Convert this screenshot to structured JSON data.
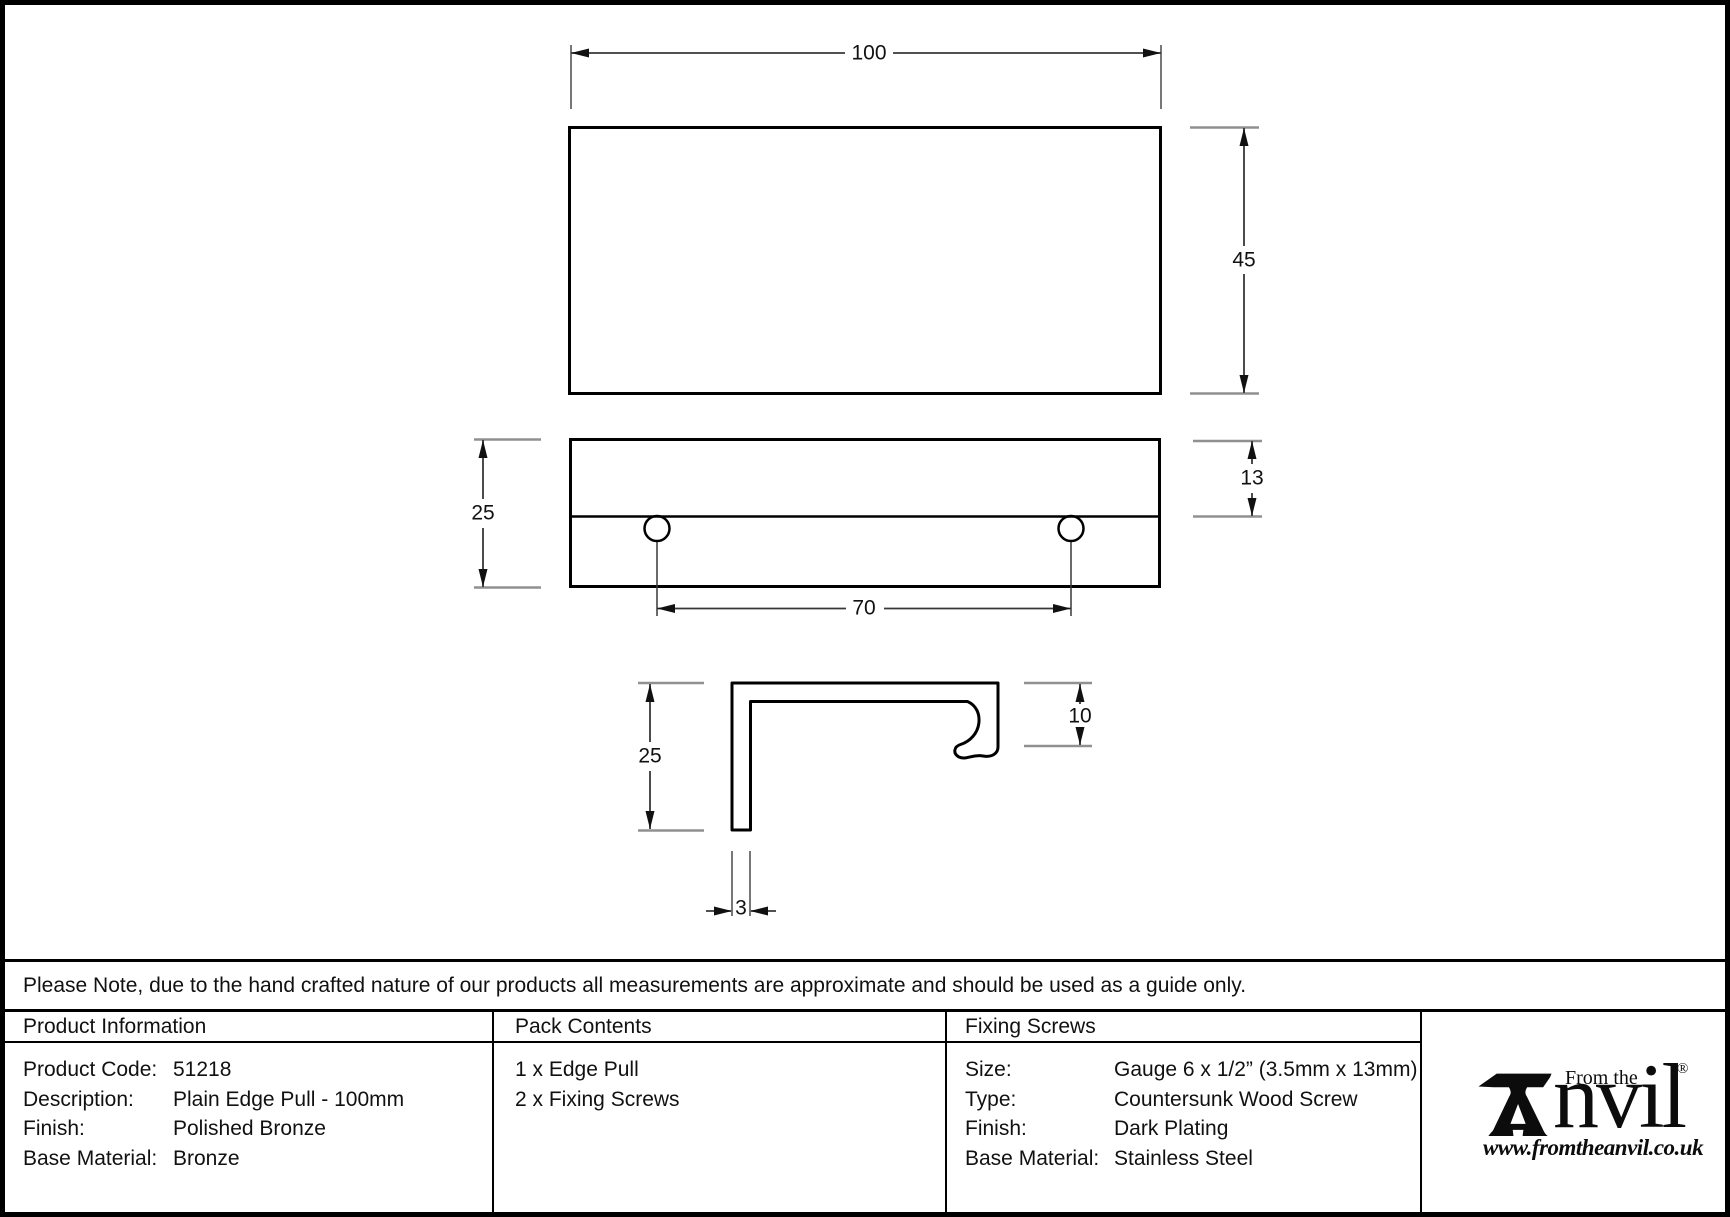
{
  "drawing": {
    "top_view": {
      "width_label": "100",
      "height_label": "45"
    },
    "front_view": {
      "height_label": "25",
      "lip_label": "13",
      "hole_spacing_label": "70"
    },
    "side_view": {
      "height_label": "25",
      "hook_label": "10",
      "thickness_label": "3"
    }
  },
  "note": "Please Note, due to the hand crafted nature of our products all measurements are approximate and should be used as a guide only.",
  "table": {
    "product_information": {
      "header": "Product Information",
      "rows": [
        {
          "label": "Product Code:",
          "value": "51218"
        },
        {
          "label": "Description:",
          "value": "Plain Edge Pull - 100mm"
        },
        {
          "label": "Finish:",
          "value": "Polished Bronze"
        },
        {
          "label": "Base Material:",
          "value": "Bronze"
        }
      ]
    },
    "pack_contents": {
      "header": "Pack Contents",
      "items": [
        "1 x Edge Pull",
        "2 x Fixing Screws"
      ]
    },
    "fixing_screws": {
      "header": "Fixing Screws",
      "rows": [
        {
          "label": "Size:",
          "value": "Gauge 6 x 1/2” (3.5mm x 13mm)"
        },
        {
          "label": "Type:",
          "value": "Countersunk Wood Screw"
        },
        {
          "label": "Finish:",
          "value": "Dark Plating"
        },
        {
          "label": "Base Material:",
          "value": "Stainless Steel"
        }
      ]
    }
  },
  "logo": {
    "tagline": "From the",
    "wordmark": "nvil",
    "registered": "®",
    "website": "www.fromtheanvil.co.uk"
  },
  "colors": {
    "ink": "#000000",
    "paper": "#ffffff",
    "witness_gray": "#909090"
  }
}
